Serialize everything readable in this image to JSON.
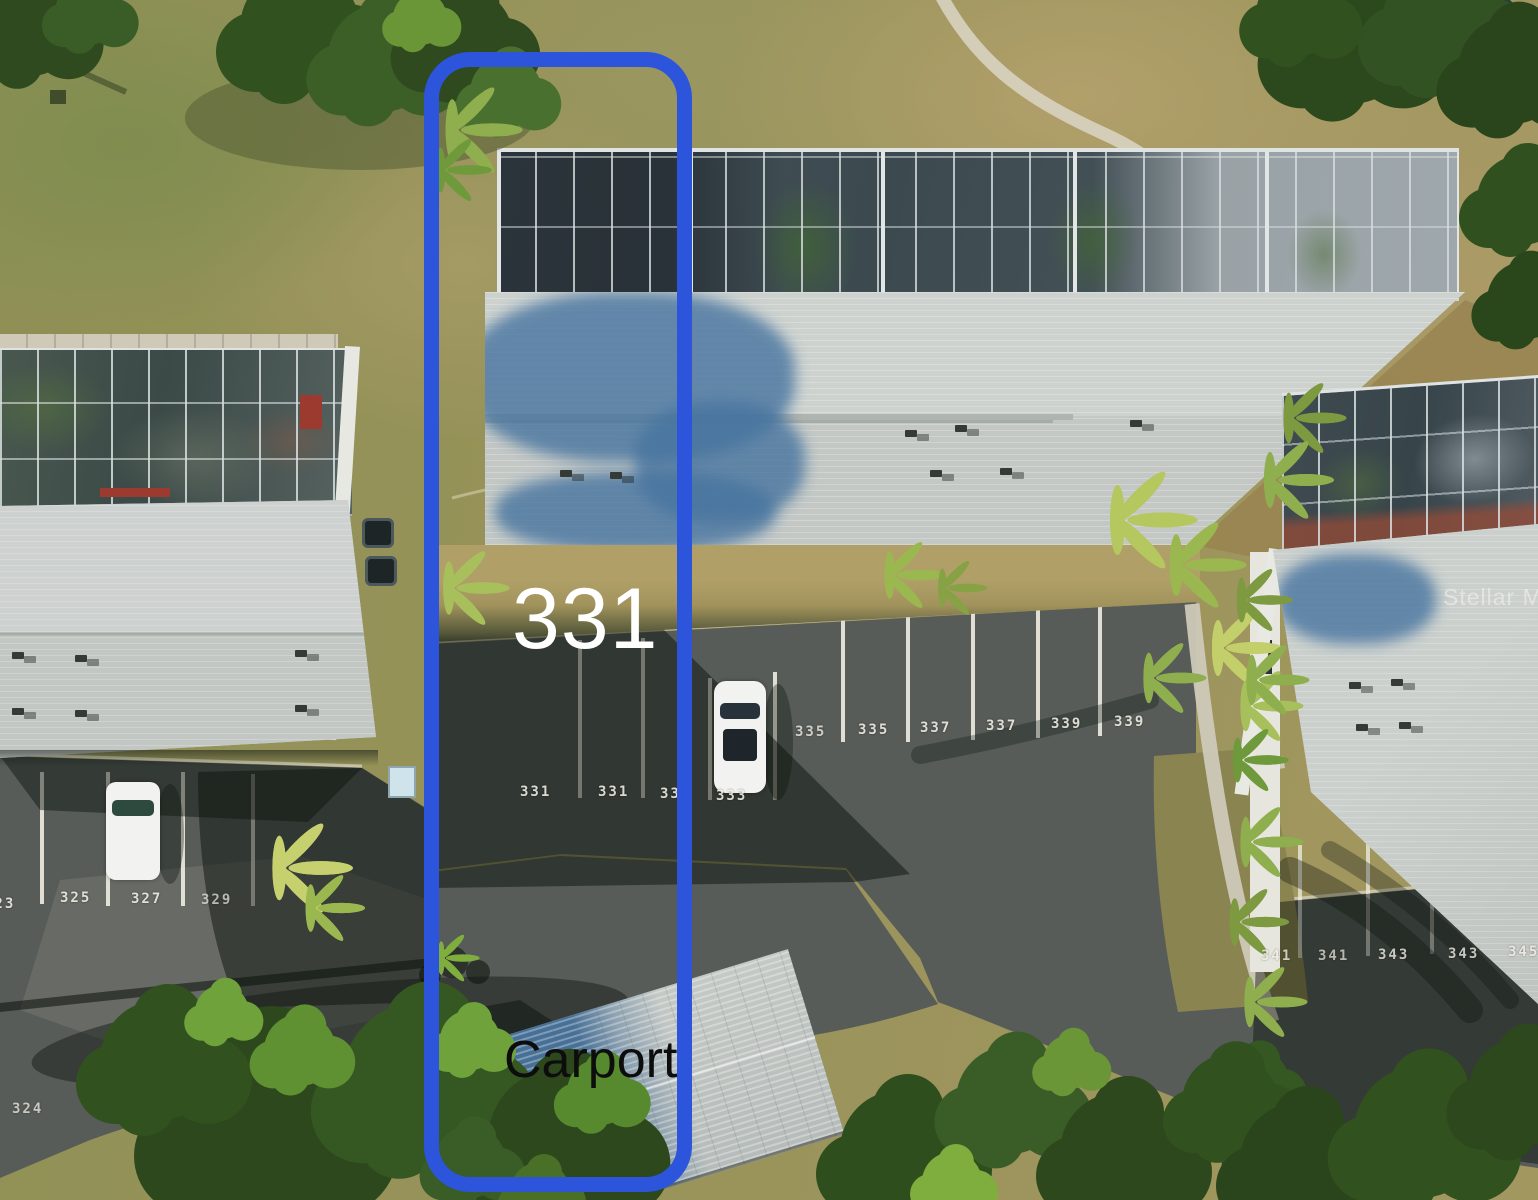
{
  "annotations": {
    "unit_number": "331",
    "carport_label": "Carport",
    "highlight_color": "#2d55dc"
  },
  "watermark": {
    "text": "Stellar MLS"
  },
  "parking_numbers": {
    "west_lot": [
      "323",
      "325",
      "327",
      "329"
    ],
    "west_drive": [
      "324"
    ],
    "unit_row": [
      "331",
      "331",
      "333",
      "333"
    ],
    "guest_row": [
      "335",
      "335",
      "337",
      "337",
      "339",
      "339"
    ],
    "southeast_lot": [
      "341",
      "341",
      "343",
      "343",
      "345"
    ]
  },
  "scene": {
    "colors": {
      "asphalt": "#575c58",
      "roof_shingle": "#c7cbc8",
      "grass": "#98935d",
      "tree_shadow_on_roof": "#47749f",
      "parking_line": "#edebe0"
    }
  }
}
